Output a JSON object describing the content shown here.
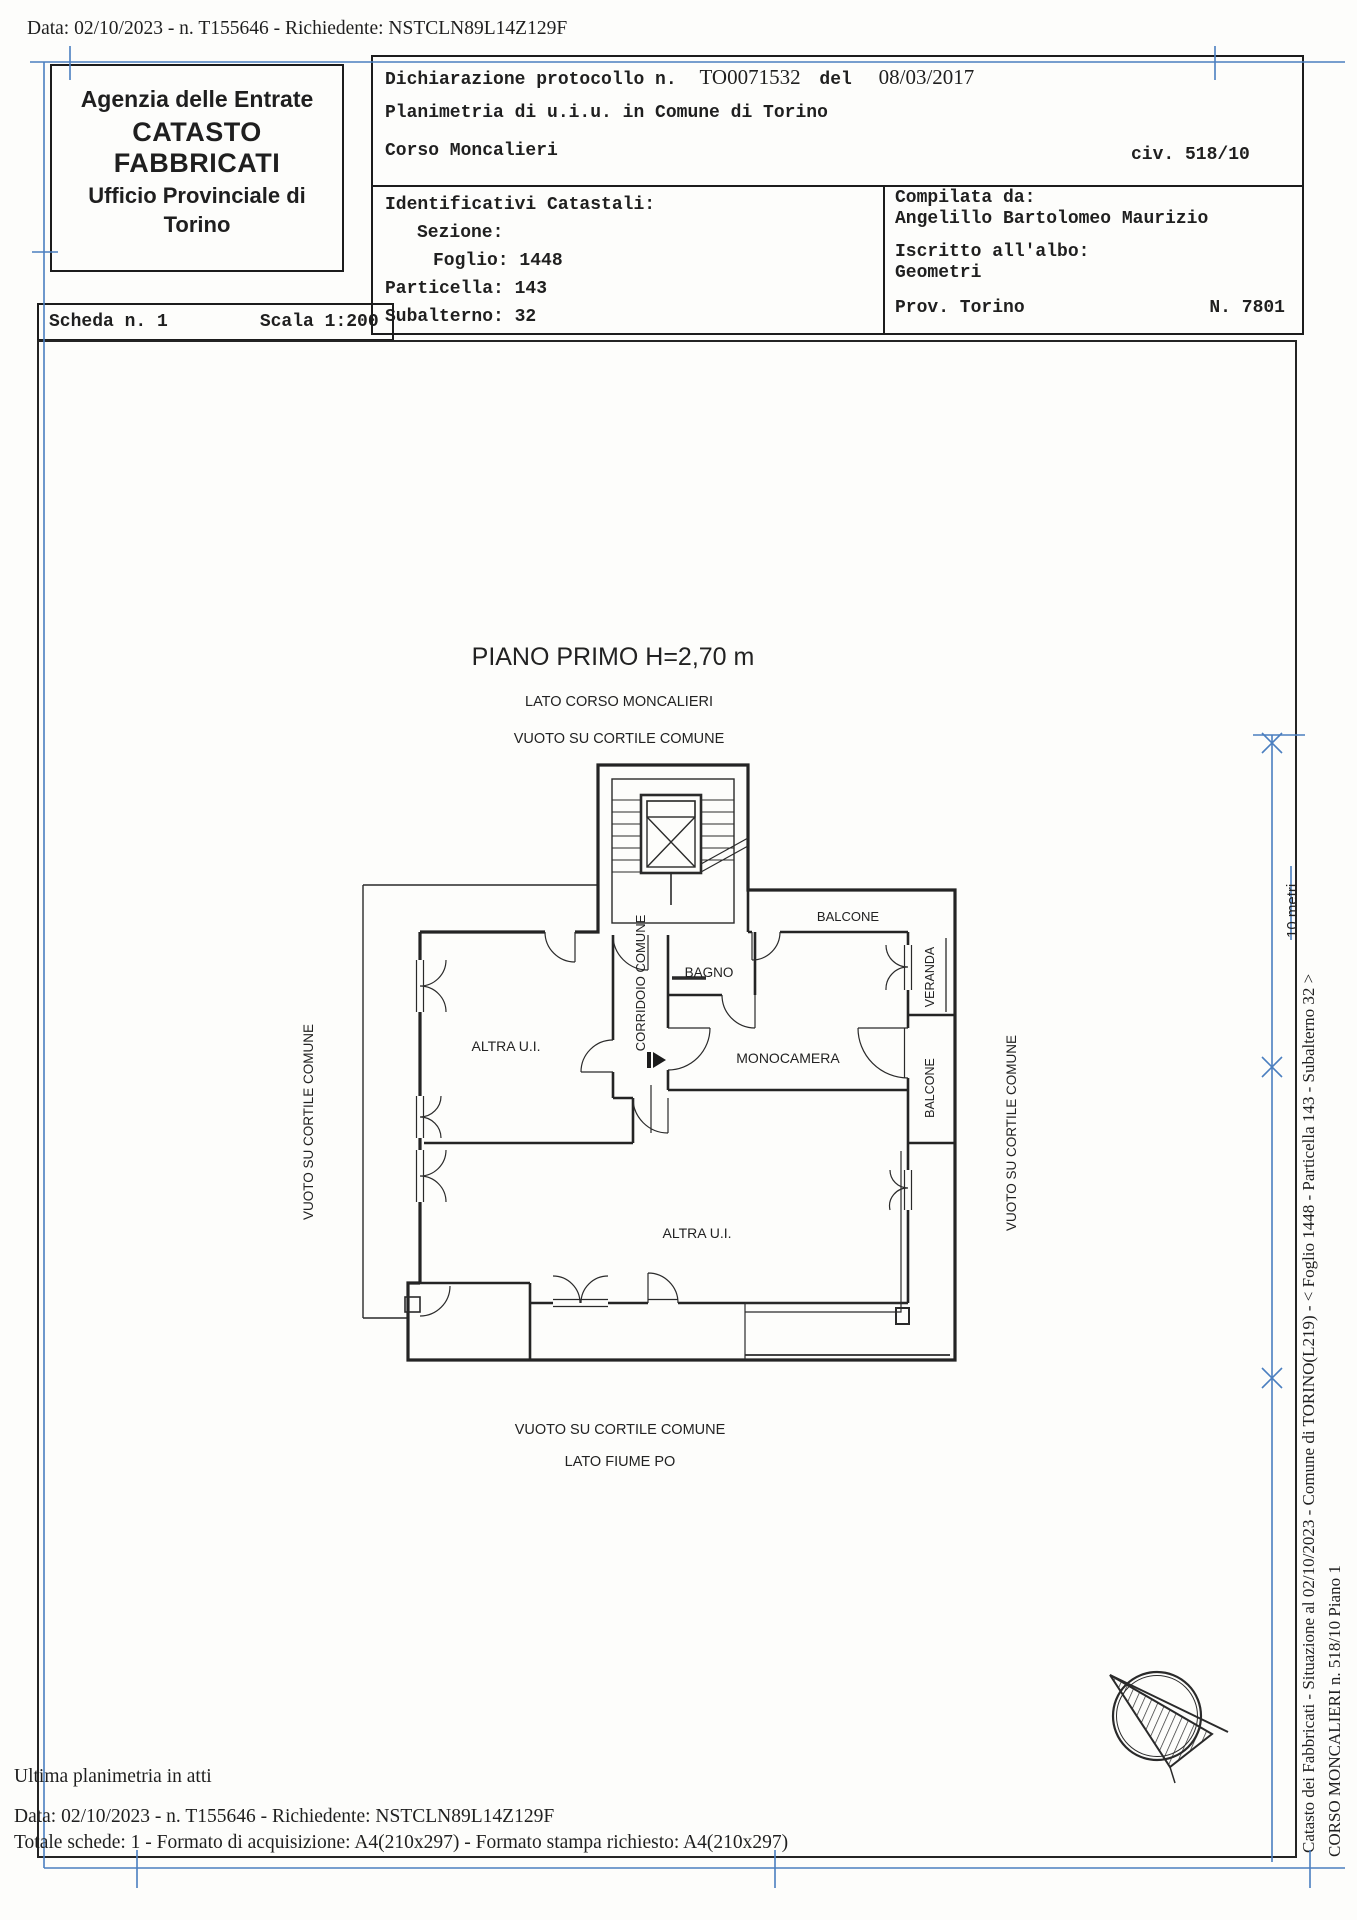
{
  "colors": {
    "blue": "#4b7fc0",
    "ink": "#1f1f1f"
  },
  "top_line": "Data: 02/10/2023 - n. T155646 - Richiedente: NSTCLN89L14Z129F",
  "agency": {
    "line1": "Agenzia delle Entrate",
    "line2": "CATASTO FABBRICATI",
    "line3": "Ufficio Provinciale di",
    "line4": "Torino"
  },
  "declaration": {
    "protocol_label": "Dichiarazione protocollo n.",
    "protocol_number": "TO0071532",
    "del_label": "del",
    "protocol_date": "08/03/2017",
    "planimetria": "Planimetria di u.i.u. in Comune di Torino",
    "street": "Corso Moncalieri",
    "civic": "civ. 518/10"
  },
  "identificativi": {
    "title": "Identificativi Catastali:",
    "sezione_label": "Sezione:",
    "foglio_label": "Foglio: ",
    "foglio": "1448",
    "particella_label": "Particella: ",
    "particella": "143",
    "subalterno_label": "Subalterno: ",
    "subalterno": "32"
  },
  "compilata": {
    "title": "Compilata da:",
    "name": "Angelillo Bartolomeo Maurizio",
    "albo_label": "Iscritto all'albo:",
    "albo": "Geometri",
    "prov": "Prov. Torino",
    "albo_number": "N. 7801"
  },
  "scheda": {
    "scheda": "Scheda n. 1",
    "scala": "Scala 1:200"
  },
  "plan": {
    "title": "PIANO PRIMO H=2,70 m",
    "lato_top": "LATO CORSO MONCALIERI",
    "vuoto_top": "VUOTO SU CORTILE COMUNE",
    "balcone_top": "BALCONE",
    "bagno": "BAGNO",
    "veranda": "VERANDA",
    "corridoio": "CORRIDOIO COMUNE",
    "altra_ui_upper": "ALTRA U.I.",
    "monocamera": "MONOCAMERA",
    "balcone_right": "BALCONE",
    "vuoto_left": "VUOTO SU CORTILE COMUNE",
    "vuoto_right": "VUOTO SU CORTILE COMUNE",
    "altra_ui_lower": "ALTRA U.I.",
    "vuoto_bottom": "VUOTO SU CORTILE COMUNE",
    "lato_bottom": "LATO FIUME PO",
    "scale_note": "10 metri"
  },
  "footer": {
    "line1": "Ultima planimetria in atti",
    "line2": "Data: 02/10/2023 - n. T155646 - Richiedente: NSTCLN89L14Z129F",
    "line3": "Totale schede: 1 - Formato di acquisizione: A4(210x297)  - Formato stampa richiesto: A4(210x297)"
  },
  "sidebar": {
    "line1": "Catasto dei Fabbricati - Situazione al 02/10/2023 - Comune di TORINO(L219) - < Foglio 1448 - Particella 143 - Subalterno 32 >",
    "line2": "CORSO MONCALIERI n. 518/10 Piano 1"
  }
}
